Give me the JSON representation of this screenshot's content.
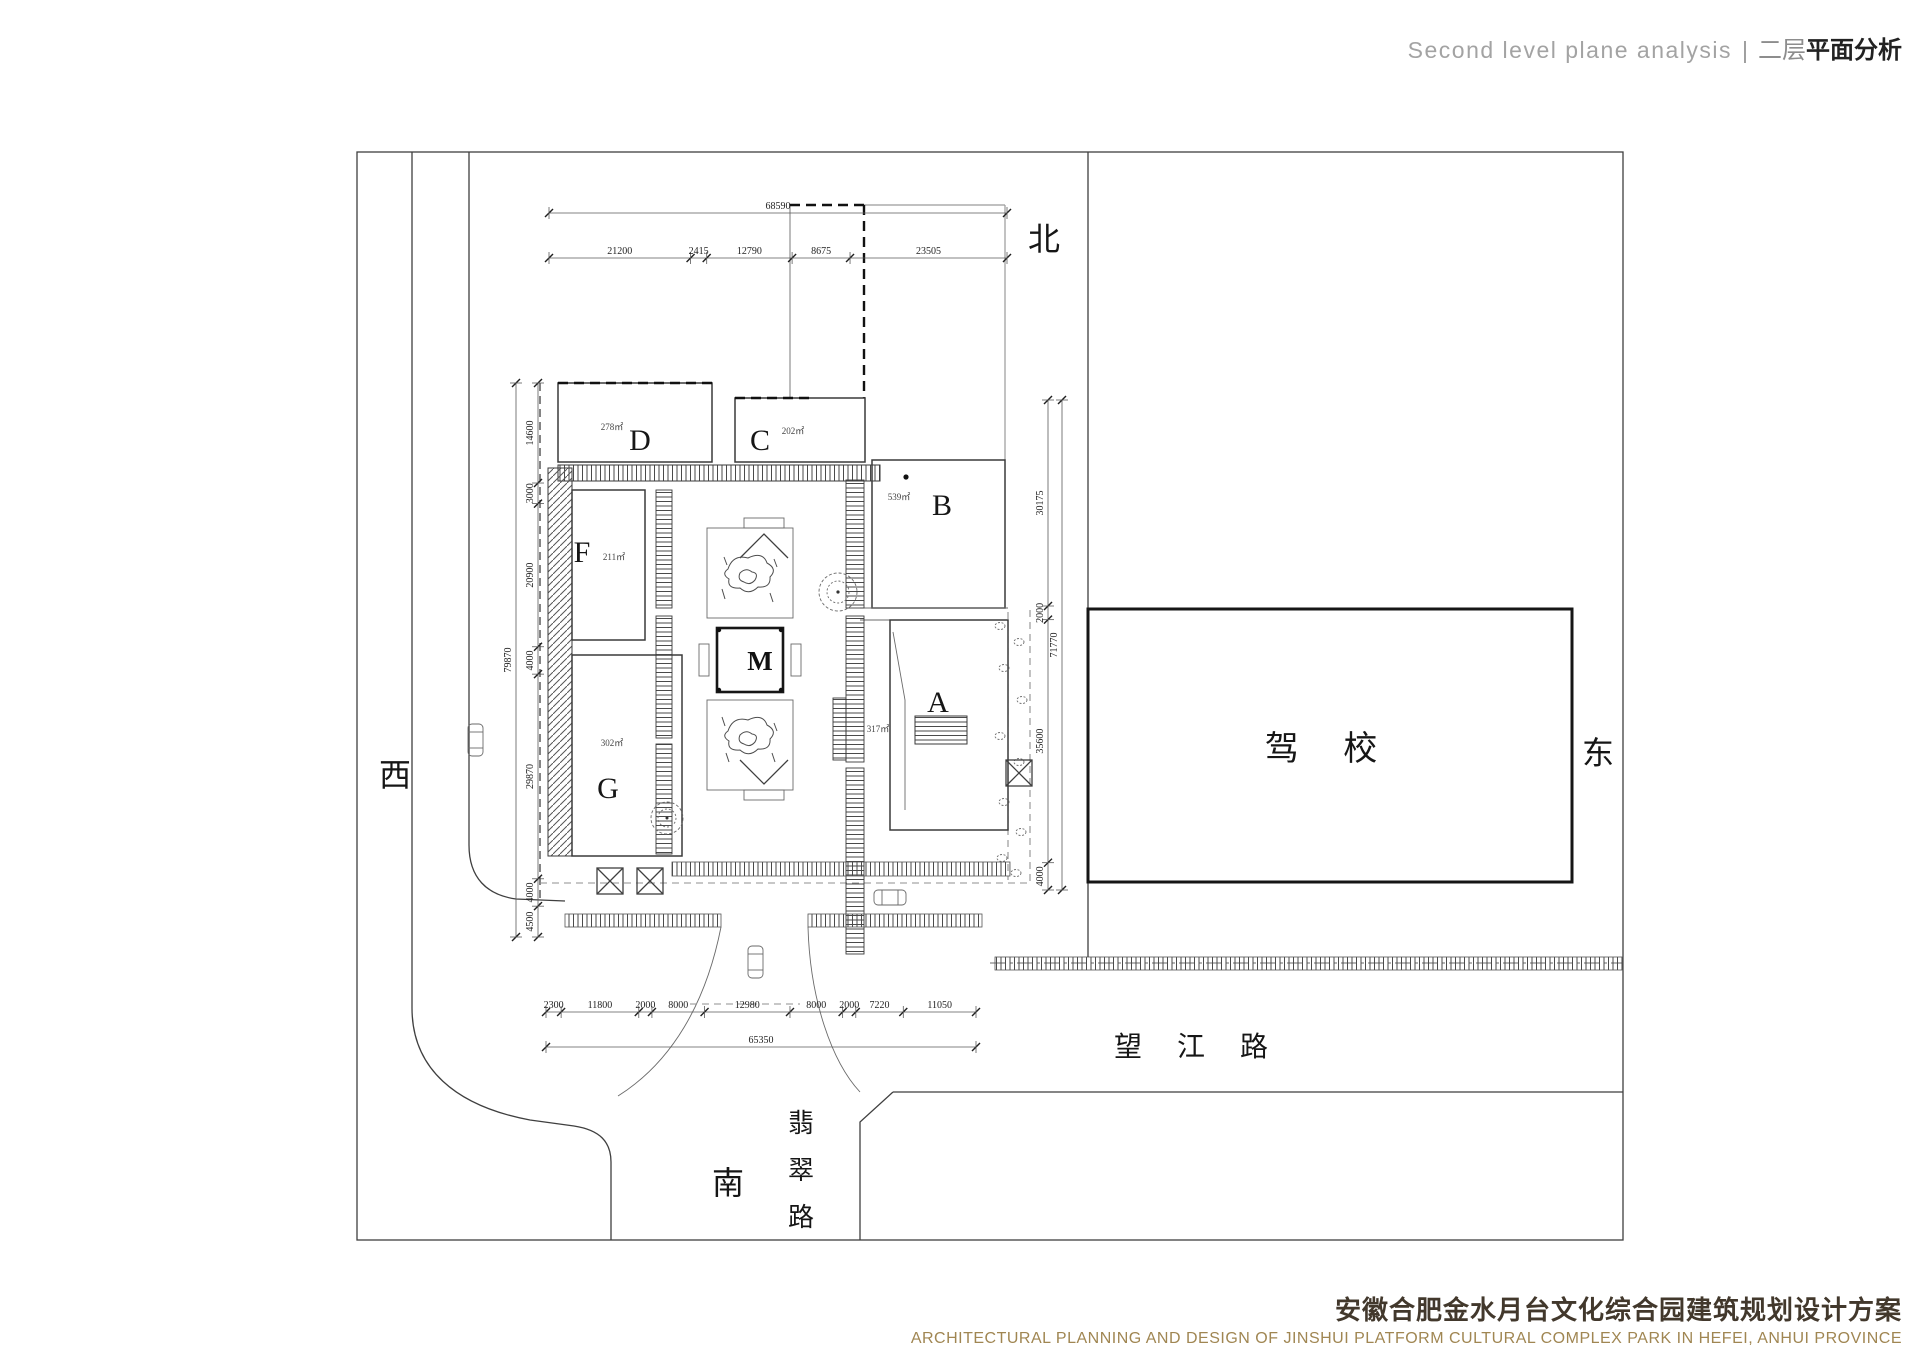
{
  "header": {
    "en": "Second level plane analysis",
    "sep": "|",
    "zh_light": "二层",
    "zh_bold": "平面分析"
  },
  "footer": {
    "zh": "安徽合肥金水月台文化综合园建筑规划设计方案",
    "en": "ARCHITECTURAL PLANNING AND DESIGN OF JINSHUI PLATFORM CULTURAL COMPLEX PARK IN HEFEI, ANHUI PROVINCE"
  },
  "compass": {
    "north": "北",
    "east": "东",
    "south": "南",
    "west": "西"
  },
  "roads": {
    "wangjiang": "望 江 路",
    "feicui_chars": [
      "翡",
      "翠",
      "路"
    ]
  },
  "labels": {
    "driving_school": "驾 校"
  },
  "buildings": {
    "A": {
      "label": "A",
      "area": "317㎡"
    },
    "B": {
      "label": "B",
      "area": "539㎡"
    },
    "C": {
      "label": "C",
      "area": "202㎡"
    },
    "D": {
      "label": "D",
      "area": "278㎡"
    },
    "F": {
      "label": "F",
      "area": "211㎡"
    },
    "G": {
      "label": "G",
      "area": "302㎡"
    },
    "M": {
      "label": "M"
    }
  },
  "dimensions": {
    "top": {
      "total": "68590",
      "segments": [
        "21200",
        "2415",
        "12790",
        "8675",
        "23505"
      ]
    },
    "bottom": {
      "total": "65350",
      "segments": [
        "2300",
        "11800",
        "2000",
        "8000",
        "12980",
        "8000",
        "2000",
        "7220",
        "11050"
      ]
    },
    "left": {
      "total": "79870",
      "segments": [
        "14600",
        "3000",
        "20900",
        "4000",
        "29870",
        "4000",
        "4500"
      ]
    },
    "right": {
      "total": "71770",
      "segments": [
        "30175",
        "2000",
        "35600",
        "4000"
      ]
    }
  },
  "colors": {
    "line": "#3f3f3f",
    "bold_line": "#161616",
    "title_brown": "#a08652",
    "title_dark": "#42382c"
  }
}
